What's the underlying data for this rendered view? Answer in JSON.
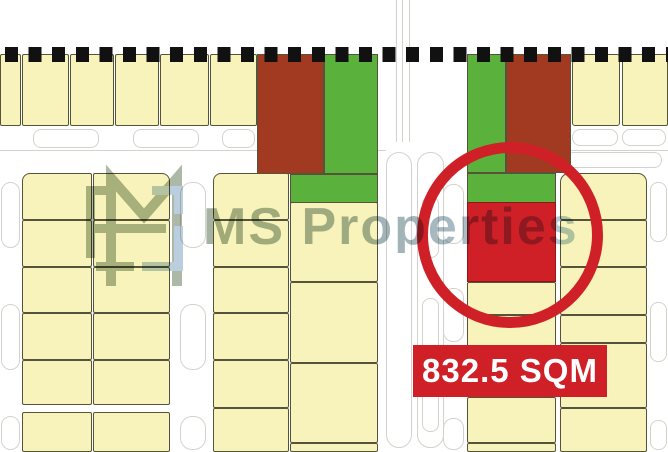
{
  "watermark": {
    "text": "MS Properties"
  },
  "label": {
    "text": "832.5 SQM"
  },
  "colors": {
    "parcel": "#f7f3ba",
    "parcel_border": "#55533a",
    "green": "#5ab23c",
    "maroon": "#a23a22",
    "highlight": "#d02027",
    "decor_line": "#d3d3cd",
    "boundary": "#111111",
    "watermark_sage": "#91a089",
    "watermark_blue": "#a3bed2"
  },
  "map": {
    "shapes": [
      {
        "t": "line",
        "x": 396,
        "y": 0,
        "w": 1,
        "h": 142
      },
      {
        "t": "line",
        "x": 402,
        "y": 0,
        "w": 1,
        "h": 142
      },
      {
        "t": "line",
        "x": 409,
        "y": 0,
        "w": 1,
        "h": 142
      },
      {
        "t": "line",
        "x": 0,
        "y": 150,
        "w": 386,
        "h": 1
      },
      {
        "t": "line",
        "x": 556,
        "y": 150,
        "w": 112,
        "h": 1
      },
      {
        "t": "out",
        "x": 386,
        "y": 152,
        "w": 26,
        "h": 296,
        "rx": 13
      },
      {
        "t": "out",
        "x": 417,
        "y": 152,
        "w": 27,
        "h": 296,
        "rx": 13
      },
      {
        "t": "out",
        "x": 422,
        "y": 196,
        "w": 17,
        "h": 62,
        "rx": 8
      },
      {
        "t": "out",
        "x": 422,
        "y": 298,
        "w": 17,
        "h": 56,
        "rx": 8
      },
      {
        "t": "out",
        "x": 422,
        "y": 388,
        "w": 17,
        "h": 44,
        "rx": 8
      },
      {
        "t": "out",
        "x": 33,
        "y": 129,
        "w": 66,
        "h": 19,
        "rx": 8
      },
      {
        "t": "out",
        "x": 133,
        "y": 129,
        "w": 66,
        "h": 19,
        "rx": 8
      },
      {
        "t": "out",
        "x": 222,
        "y": 129,
        "w": 33,
        "h": 19,
        "rx": 8
      },
      {
        "t": "out",
        "x": 572,
        "y": 129,
        "w": 46,
        "h": 17,
        "rx": 8
      },
      {
        "t": "out",
        "x": 622,
        "y": 129,
        "w": 44,
        "h": 17,
        "rx": 8
      },
      {
        "t": "out",
        "x": 566,
        "y": 152,
        "w": 96,
        "h": 16,
        "rx": 8
      },
      {
        "t": "out",
        "x": 1,
        "y": 182,
        "w": 19,
        "h": 66,
        "rx": 10
      },
      {
        "t": "out",
        "x": 1,
        "y": 304,
        "w": 19,
        "h": 66,
        "rx": 10
      },
      {
        "t": "out",
        "x": 1,
        "y": 416,
        "w": 19,
        "h": 34,
        "rx": 10
      },
      {
        "t": "out",
        "x": 180,
        "y": 182,
        "w": 26,
        "h": 66,
        "rx": 12
      },
      {
        "t": "out",
        "x": 180,
        "y": 304,
        "w": 26,
        "h": 66,
        "rx": 12
      },
      {
        "t": "out",
        "x": 180,
        "y": 416,
        "w": 26,
        "h": 34,
        "rx": 12
      },
      {
        "t": "out",
        "x": 443,
        "y": 184,
        "w": 21,
        "h": 60,
        "rx": 10
      },
      {
        "t": "out",
        "x": 443,
        "y": 288,
        "w": 21,
        "h": 54,
        "rx": 10
      },
      {
        "t": "out",
        "x": 443,
        "y": 418,
        "w": 21,
        "h": 32,
        "rx": 10
      },
      {
        "t": "out",
        "x": 650,
        "y": 182,
        "w": 17,
        "h": 60,
        "rx": 8
      },
      {
        "t": "out",
        "x": 650,
        "y": 302,
        "w": 17,
        "h": 60,
        "rx": 8
      },
      {
        "t": "out",
        "x": 650,
        "y": 420,
        "w": 17,
        "h": 30,
        "rx": 8
      },
      {
        "t": "par",
        "x": 0,
        "y": 54,
        "w": 21,
        "h": 72
      },
      {
        "t": "par",
        "x": 22,
        "y": 54,
        "w": 47,
        "h": 72
      },
      {
        "t": "par",
        "x": 70,
        "y": 54,
        "w": 44,
        "h": 72
      },
      {
        "t": "par",
        "x": 115,
        "y": 54,
        "w": 44,
        "h": 72
      },
      {
        "t": "par",
        "x": 160,
        "y": 54,
        "w": 49,
        "h": 72
      },
      {
        "t": "par",
        "x": 210,
        "y": 54,
        "w": 47,
        "h": 72
      },
      {
        "t": "par",
        "x": 572,
        "y": 54,
        "w": 48,
        "h": 72,
        "r": "10px 3px 3px 3px"
      },
      {
        "t": "par",
        "x": 622,
        "y": 54,
        "w": 46,
        "h": 72
      },
      {
        "t": "par",
        "x": 22,
        "y": 173,
        "w": 70,
        "h": 47,
        "r": "8px 2px 2px 2px"
      },
      {
        "t": "par",
        "x": 93,
        "y": 173,
        "w": 77,
        "h": 47,
        "r": "2px 8px 2px 2px"
      },
      {
        "t": "par",
        "x": 22,
        "y": 220,
        "w": 70,
        "h": 47
      },
      {
        "t": "par",
        "x": 93,
        "y": 220,
        "w": 77,
        "h": 47
      },
      {
        "t": "par",
        "x": 22,
        "y": 267,
        "w": 70,
        "h": 46
      },
      {
        "t": "par",
        "x": 93,
        "y": 267,
        "w": 77,
        "h": 46
      },
      {
        "t": "par",
        "x": 22,
        "y": 313,
        "w": 70,
        "h": 47
      },
      {
        "t": "par",
        "x": 93,
        "y": 313,
        "w": 77,
        "h": 47
      },
      {
        "t": "par",
        "x": 22,
        "y": 360,
        "w": 70,
        "h": 45
      },
      {
        "t": "par",
        "x": 93,
        "y": 360,
        "w": 77,
        "h": 45
      },
      {
        "t": "par",
        "x": 22,
        "y": 412,
        "w": 70,
        "h": 40
      },
      {
        "t": "par",
        "x": 93,
        "y": 412,
        "w": 77,
        "h": 40
      },
      {
        "t": "par",
        "x": 213,
        "y": 173,
        "w": 76,
        "h": 47,
        "r": "8px 2px 2px 2px"
      },
      {
        "t": "par",
        "x": 213,
        "y": 220,
        "w": 76,
        "h": 47
      },
      {
        "t": "par",
        "x": 213,
        "y": 267,
        "w": 76,
        "h": 46
      },
      {
        "t": "par",
        "x": 213,
        "y": 313,
        "w": 76,
        "h": 47
      },
      {
        "t": "par",
        "x": 213,
        "y": 360,
        "w": 76,
        "h": 48
      },
      {
        "t": "par",
        "x": 213,
        "y": 408,
        "w": 76,
        "h": 44
      },
      {
        "t": "par",
        "x": 290,
        "y": 202,
        "w": 88,
        "h": 80
      },
      {
        "t": "par",
        "x": 290,
        "y": 282,
        "w": 88,
        "h": 81
      },
      {
        "t": "par",
        "x": 290,
        "y": 363,
        "w": 88,
        "h": 80
      },
      {
        "t": "par",
        "x": 290,
        "y": 443,
        "w": 88,
        "h": 9
      },
      {
        "t": "par",
        "x": 467,
        "y": 282,
        "w": 89,
        "h": 33
      },
      {
        "t": "par",
        "x": 467,
        "y": 315,
        "w": 89,
        "h": 82
      },
      {
        "t": "par",
        "x": 467,
        "y": 397,
        "w": 89,
        "h": 46
      },
      {
        "t": "par",
        "x": 467,
        "y": 443,
        "w": 89,
        "h": 9
      },
      {
        "t": "par",
        "x": 560,
        "y": 173,
        "w": 87,
        "h": 47,
        "r": "9px 9px 2px 2px"
      },
      {
        "t": "par",
        "x": 560,
        "y": 220,
        "w": 87,
        "h": 47
      },
      {
        "t": "par",
        "x": 560,
        "y": 267,
        "w": 87,
        "h": 48
      },
      {
        "t": "par",
        "x": 560,
        "y": 315,
        "w": 87,
        "h": 28
      },
      {
        "t": "par",
        "x": 560,
        "y": 343,
        "w": 87,
        "h": 65
      },
      {
        "t": "par",
        "x": 560,
        "y": 408,
        "w": 87,
        "h": 44
      },
      {
        "t": "green",
        "x": 324,
        "y": 54,
        "w": 54,
        "h": 120
      },
      {
        "t": "green",
        "x": 290,
        "y": 174,
        "w": 88,
        "h": 29
      },
      {
        "t": "green",
        "x": 467,
        "y": 54,
        "w": 39,
        "h": 119
      },
      {
        "t": "green",
        "x": 467,
        "y": 173,
        "w": 89,
        "h": 30
      },
      {
        "t": "maroon",
        "x": 257,
        "y": 54,
        "w": 67,
        "h": 120
      },
      {
        "t": "maroon",
        "x": 506,
        "y": 54,
        "w": 65,
        "h": 119
      },
      {
        "t": "red",
        "x": 467,
        "y": 202,
        "w": 89,
        "h": 80
      }
    ]
  }
}
